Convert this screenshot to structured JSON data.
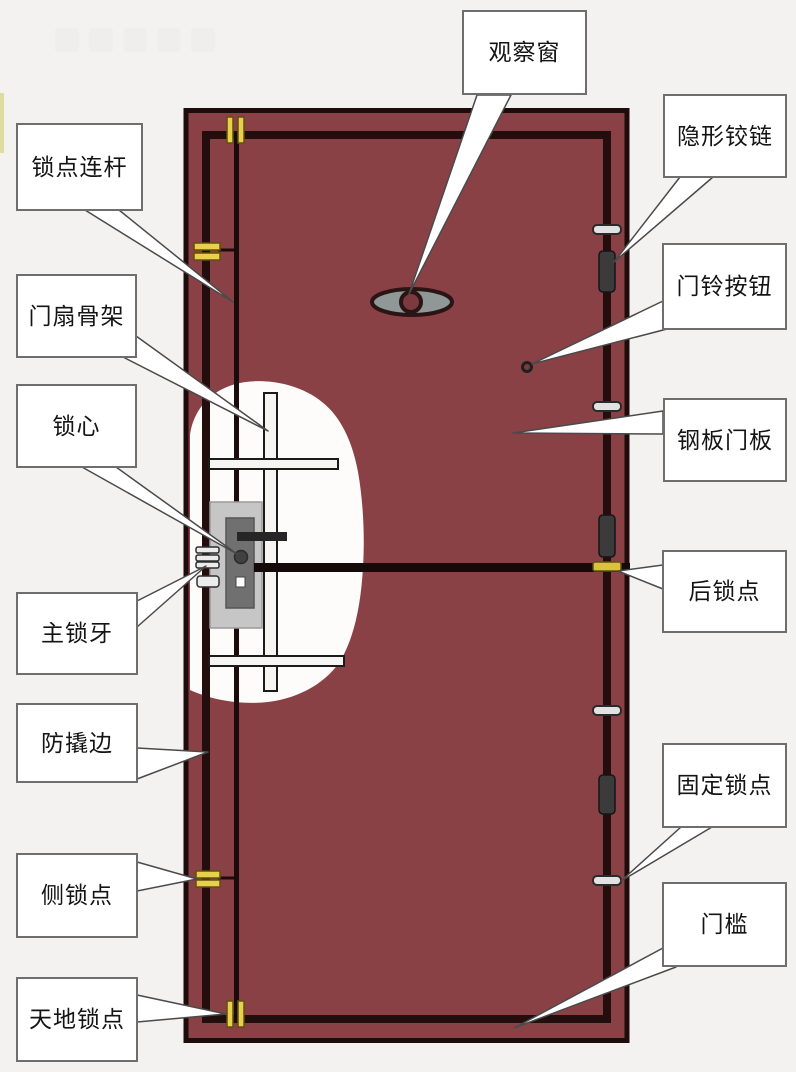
{
  "figure": {
    "kind": "labeled cutaway diagram of a security door"
  },
  "labels": [
    {
      "id": "observation-window",
      "text": "观察窗"
    },
    {
      "id": "hidden-hinge",
      "text": "隐形铰链"
    },
    {
      "id": "lock-point-rod",
      "text": "锁点连杆"
    },
    {
      "id": "doorbell-button",
      "text": "门铃按钮"
    },
    {
      "id": "door-leaf-frame",
      "text": "门扇骨架"
    },
    {
      "id": "steel-door-panel",
      "text": "钢板门板"
    },
    {
      "id": "lock-cylinder",
      "text": "锁心"
    },
    {
      "id": "rear-lock-point",
      "text": "后锁点"
    },
    {
      "id": "main-lock-bolt",
      "text": "主锁牙"
    },
    {
      "id": "anti-pry-edge",
      "text": "防撬边"
    },
    {
      "id": "fixed-lock-point",
      "text": "固定锁点"
    },
    {
      "id": "side-lock-point",
      "text": "侧锁点"
    },
    {
      "id": "door-sill",
      "text": "门槛"
    },
    {
      "id": "top-bottom-lock-point",
      "text": "天地锁点"
    }
  ],
  "colors": {
    "background": "#f4f2f0",
    "door_panel": "#8a4145",
    "door_outline": "#1e0c0c",
    "inner_frame_line": "#240d0d",
    "lock_point_yellow": "#e9d04b",
    "lock_point_yellow_outline": "#5f4f12",
    "hinge_dark": "#3b3b3b",
    "hinge_pin_grey": "#e2e2e2",
    "cutaway_white": "#fdfcfa",
    "lock_body_grey": "#c6c6c6",
    "lock_inner_grey": "#707070",
    "peephole_grey": "#8f9797",
    "label_box_background": "#ffffff",
    "label_box_border": "#6e6e6e",
    "label_text": "#141414"
  },
  "door_parts_iconography": [
    "door-panel",
    "inner-panel-outline",
    "lock-point-rod-line",
    "peephole-icon",
    "doorbell-button-icon",
    "hinge-icon",
    "hinge-pin-icon",
    "lock-body-icon",
    "lock-cylinder-core-icon",
    "main-lock-bolts-icon",
    "horizontal-lock-bar",
    "side-lock-point-icon",
    "top-bottom-lock-point-icon",
    "rear-lock-point-icon",
    "fixed-lock-point-icon",
    "cutaway-window",
    "skeleton-rail"
  ]
}
